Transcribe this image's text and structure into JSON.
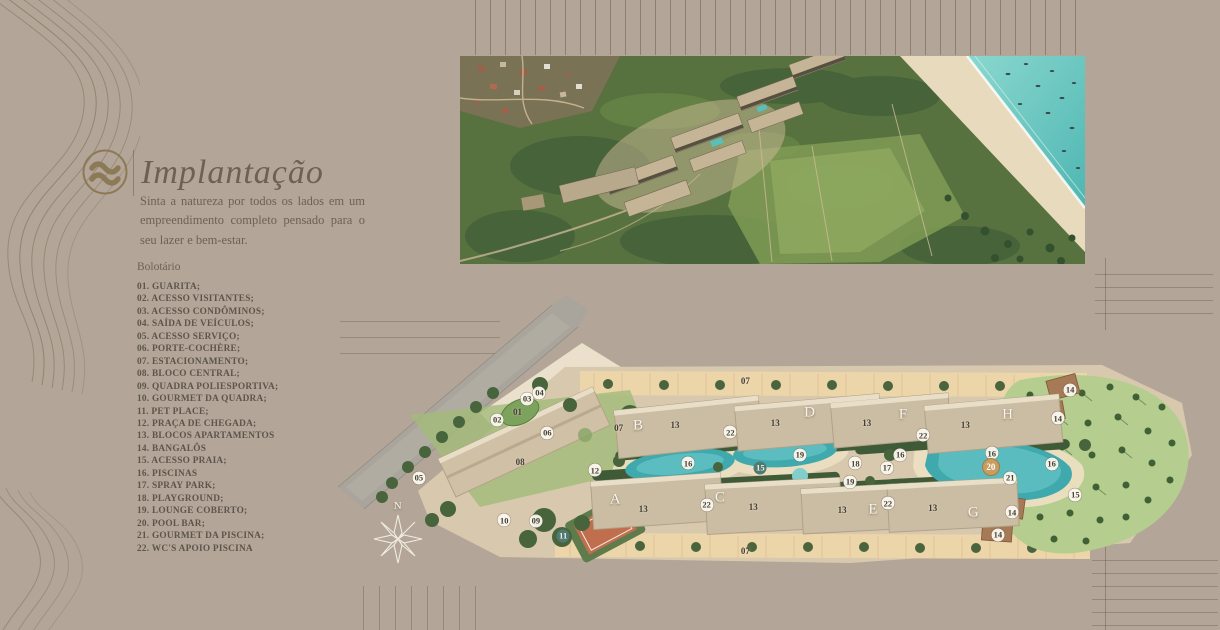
{
  "header": {
    "title": "Implantação",
    "intro": "Sinta a natureza por todos os lados em um empreendimento completo pensado para o seu lazer e bem-estar."
  },
  "legend": {
    "heading": "Bolotário",
    "items": [
      "01. GUARITA;",
      "02. ACESSO VISITANTES;",
      "03. ACESSO CONDÔMINOS;",
      "04. SAÍDA DE VEÍCULOS;",
      "05. ACESSO SERVIÇO;",
      "06. PORTE-COCHÈRE;",
      "07. ESTACIONAMENTO;",
      "08. BLOCO CENTRAL;",
      "09. QUADRA POLIESPORTIVA;",
      "10. GOURMET DA QUADRA;",
      "11. PET PLACE;",
      "12. PRAÇA DE CHEGADA;",
      "13. BLOCOS APARTAMENTOS",
      "14. BANGALÔS",
      "15. ACESSO PRAIA;",
      "16. PISCINAS",
      "17. SPRAY PARK;",
      "18. PLAYGROUND;",
      "19. LOUNGE COBERTO;",
      "20. POOL BAR;",
      "21. GOURMET DA PISCINA;",
      "22. WC'S APOIO PISCINA"
    ]
  },
  "site_plan": {
    "north_label": "N",
    "building_letters": [
      {
        "ch": "A",
        "x": 32.4,
        "y": 66.1
      },
      {
        "ch": "B",
        "x": 35.0,
        "y": 42.3
      },
      {
        "ch": "C",
        "x": 44.3,
        "y": 65.5
      },
      {
        "ch": "D",
        "x": 54.5,
        "y": 38.1
      },
      {
        "ch": "E",
        "x": 61.7,
        "y": 69.4
      },
      {
        "ch": "F",
        "x": 65.1,
        "y": 38.7
      },
      {
        "ch": "G",
        "x": 73.1,
        "y": 70.3
      },
      {
        "ch": "H",
        "x": 77.0,
        "y": 38.7
      }
    ],
    "markers": [
      {
        "n": "01",
        "x": 21.3,
        "y": 37.7,
        "s": "p"
      },
      {
        "n": "02",
        "x": 19.0,
        "y": 40.3,
        "s": "w"
      },
      {
        "n": "03",
        "x": 22.4,
        "y": 33.5,
        "s": "w"
      },
      {
        "n": "04",
        "x": 23.8,
        "y": 31.6,
        "s": "w"
      },
      {
        "n": "05",
        "x": 10.1,
        "y": 59.0,
        "s": "w"
      },
      {
        "n": "06",
        "x": 24.7,
        "y": 44.5,
        "s": "w"
      },
      {
        "n": "07",
        "x": 32.8,
        "y": 42.9,
        "s": "p"
      },
      {
        "n": "07",
        "x": 47.2,
        "y": 27.7,
        "s": "p"
      },
      {
        "n": "07",
        "x": 47.2,
        "y": 82.6,
        "s": "p"
      },
      {
        "n": "08",
        "x": 21.6,
        "y": 53.9,
        "s": "p"
      },
      {
        "n": "09",
        "x": 23.4,
        "y": 72.9,
        "s": "w"
      },
      {
        "n": "10",
        "x": 19.8,
        "y": 72.6,
        "s": "w"
      },
      {
        "n": "11",
        "x": 26.5,
        "y": 77.7,
        "s": "d"
      },
      {
        "n": "12",
        "x": 30.1,
        "y": 56.5,
        "s": "w"
      },
      {
        "n": "13",
        "x": 39.2,
        "y": 41.9,
        "s": "p"
      },
      {
        "n": "13",
        "x": 50.6,
        "y": 41.3,
        "s": "p"
      },
      {
        "n": "13",
        "x": 61.0,
        "y": 41.3,
        "s": "p"
      },
      {
        "n": "13",
        "x": 72.2,
        "y": 41.9,
        "s": "p"
      },
      {
        "n": "13",
        "x": 35.6,
        "y": 69.0,
        "s": "p"
      },
      {
        "n": "13",
        "x": 48.1,
        "y": 68.4,
        "s": "p"
      },
      {
        "n": "13",
        "x": 58.2,
        "y": 69.4,
        "s": "p"
      },
      {
        "n": "13",
        "x": 68.5,
        "y": 68.7,
        "s": "p"
      },
      {
        "n": "14",
        "x": 84.1,
        "y": 30.6,
        "s": "w"
      },
      {
        "n": "14",
        "x": 82.7,
        "y": 39.7,
        "s": "w"
      },
      {
        "n": "14",
        "x": 77.5,
        "y": 70.0,
        "s": "w"
      },
      {
        "n": "14",
        "x": 75.9,
        "y": 77.4,
        "s": "w"
      },
      {
        "n": "15",
        "x": 48.9,
        "y": 55.8,
        "s": "d"
      },
      {
        "n": "15",
        "x": 84.7,
        "y": 64.5,
        "s": "w"
      },
      {
        "n": "16",
        "x": 40.7,
        "y": 54.2,
        "s": "w"
      },
      {
        "n": "16",
        "x": 64.8,
        "y": 51.6,
        "s": "w"
      },
      {
        "n": "16",
        "x": 75.2,
        "y": 51.0,
        "s": "w"
      },
      {
        "n": "16",
        "x": 82.0,
        "y": 54.5,
        "s": "w"
      },
      {
        "n": "17",
        "x": 63.3,
        "y": 55.8,
        "s": "w"
      },
      {
        "n": "18",
        "x": 59.7,
        "y": 54.2,
        "s": "w"
      },
      {
        "n": "19",
        "x": 53.4,
        "y": 51.6,
        "s": "w"
      },
      {
        "n": "19",
        "x": 59.1,
        "y": 60.3,
        "s": "w"
      },
      {
        "n": "20",
        "x": 75.1,
        "y": 55.5,
        "s": "g"
      },
      {
        "n": "21",
        "x": 77.3,
        "y": 59.0,
        "s": "w"
      },
      {
        "n": "22",
        "x": 45.5,
        "y": 44.2,
        "s": "w"
      },
      {
        "n": "22",
        "x": 42.8,
        "y": 67.7,
        "s": "w"
      },
      {
        "n": "22",
        "x": 67.4,
        "y": 45.2,
        "s": "w"
      },
      {
        "n": "22",
        "x": 63.4,
        "y": 67.1,
        "s": "w"
      }
    ]
  },
  "colors": {
    "background": "#b3a698",
    "accent_gold": "#8c7a57",
    "text": "#655b50",
    "pool": "#3fa9ae",
    "sea": "#6fccc4",
    "sand": "#e7d8bb",
    "parcel": "#d8c9ae",
    "vegetation": "#4b663d"
  }
}
